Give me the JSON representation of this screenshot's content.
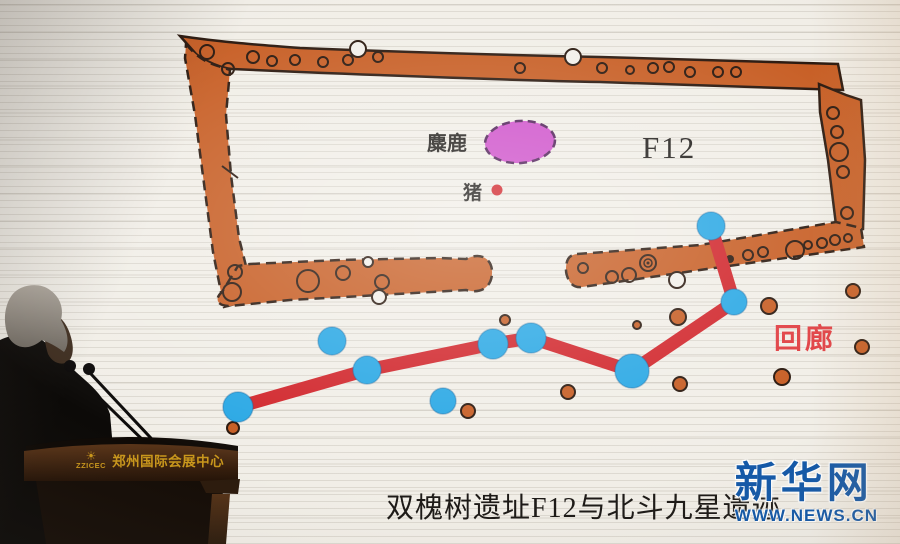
{
  "photo": {
    "caption": "双槐树遗址F12与北斗九星遗迹"
  },
  "slide": {
    "labels": {
      "elk": "麋鹿",
      "pig": "猪",
      "building": "F12",
      "corridor": "回廊"
    }
  },
  "watermark": {
    "site_name": "新华网",
    "site_url": "WWW.NEWS.CN"
  },
  "podium": {
    "abbr": "ZZICEC",
    "venue_name": "郑州国际会展中心",
    "sunburst_icon": "☀"
  },
  "colors": {
    "wall": "#c65a1f",
    "wall_outline": "#241208",
    "star": "#25a6e4",
    "line": "#d02127",
    "oval": "#ce4fca",
    "oval_outline": "#4d1c55",
    "corridor_label": "#e03a3e",
    "logo_blue": "#1459a8",
    "gold": "#c9971c"
  },
  "diagram": {
    "elk_oval": {
      "x": 520,
      "y": 142,
      "rx": 35,
      "ry": 21
    },
    "pig_dot": {
      "x": 497,
      "y": 190,
      "r": 5.5
    },
    "stars_linked": [
      {
        "x": 238,
        "y": 407,
        "r": 15
      },
      {
        "x": 367,
        "y": 370,
        "r": 14
      },
      {
        "x": 493,
        "y": 344,
        "r": 15
      },
      {
        "x": 531,
        "y": 338,
        "r": 15
      },
      {
        "x": 632,
        "y": 371,
        "r": 17
      },
      {
        "x": 734,
        "y": 302,
        "r": 13
      },
      {
        "x": 711,
        "y": 226,
        "r": 14
      }
    ],
    "stars_free": [
      {
        "x": 332,
        "y": 341,
        "r": 14
      },
      {
        "x": 443,
        "y": 401,
        "r": 13
      }
    ],
    "postholes_outside": [
      {
        "x": 233,
        "y": 428,
        "r": 6
      },
      {
        "x": 468,
        "y": 411,
        "r": 7
      },
      {
        "x": 505,
        "y": 320,
        "r": 5
      },
      {
        "x": 568,
        "y": 392,
        "r": 7
      },
      {
        "x": 637,
        "y": 325,
        "r": 4
      },
      {
        "x": 678,
        "y": 317,
        "r": 8
      },
      {
        "x": 680,
        "y": 384,
        "r": 7
      },
      {
        "x": 782,
        "y": 377,
        "r": 8
      },
      {
        "x": 769,
        "y": 306,
        "r": 8
      },
      {
        "x": 853,
        "y": 291,
        "r": 7
      },
      {
        "x": 862,
        "y": 347,
        "r": 7
      }
    ],
    "wall_holes": [
      {
        "x": 207,
        "y": 52,
        "r": 7
      },
      {
        "x": 228,
        "y": 69,
        "r": 6
      },
      {
        "x": 253,
        "y": 57,
        "r": 6
      },
      {
        "x": 272,
        "y": 61,
        "r": 5
      },
      {
        "x": 295,
        "y": 60,
        "r": 5
      },
      {
        "x": 323,
        "y": 62,
        "r": 5
      },
      {
        "x": 348,
        "y": 60,
        "r": 5
      },
      {
        "x": 378,
        "y": 57,
        "r": 5
      },
      {
        "x": 520,
        "y": 68,
        "r": 5
      },
      {
        "x": 602,
        "y": 68,
        "r": 5
      },
      {
        "x": 630,
        "y": 70,
        "r": 4
      },
      {
        "x": 653,
        "y": 68,
        "r": 5
      },
      {
        "x": 669,
        "y": 67,
        "r": 5
      },
      {
        "x": 690,
        "y": 72,
        "r": 5
      },
      {
        "x": 718,
        "y": 72,
        "r": 5
      },
      {
        "x": 736,
        "y": 72,
        "r": 5
      },
      {
        "x": 833,
        "y": 113,
        "r": 6
      },
      {
        "x": 837,
        "y": 132,
        "r": 6
      },
      {
        "x": 839,
        "y": 152,
        "r": 9
      },
      {
        "x": 843,
        "y": 172,
        "r": 6
      },
      {
        "x": 847,
        "y": 213,
        "r": 6
      },
      {
        "x": 583,
        "y": 268,
        "r": 5
      },
      {
        "x": 612,
        "y": 277,
        "r": 6
      },
      {
        "x": 629,
        "y": 275,
        "r": 7
      },
      {
        "x": 748,
        "y": 255,
        "r": 5
      },
      {
        "x": 763,
        "y": 252,
        "r": 5
      },
      {
        "x": 795,
        "y": 250,
        "r": 9
      },
      {
        "x": 808,
        "y": 245,
        "r": 4
      },
      {
        "x": 822,
        "y": 243,
        "r": 5
      },
      {
        "x": 835,
        "y": 240,
        "r": 5
      },
      {
        "x": 848,
        "y": 238,
        "r": 4
      },
      {
        "x": 235,
        "y": 272,
        "r": 7
      },
      {
        "x": 232,
        "y": 292,
        "r": 9
      },
      {
        "x": 308,
        "y": 281,
        "r": 11
      },
      {
        "x": 343,
        "y": 273,
        "r": 7
      },
      {
        "x": 382,
        "y": 282,
        "r": 7
      }
    ],
    "white_holes": [
      {
        "x": 358,
        "y": 49,
        "r": 8
      },
      {
        "x": 573,
        "y": 57,
        "r": 8
      },
      {
        "x": 368,
        "y": 262,
        "r": 5
      },
      {
        "x": 379,
        "y": 297,
        "r": 7
      },
      {
        "x": 677,
        "y": 280,
        "r": 8
      }
    ],
    "dark_dots": [
      {
        "x": 730,
        "y": 259,
        "r": 4
      }
    ],
    "double_ring": {
      "x": 648,
      "y": 263,
      "r_outer": 8,
      "r_inner": 4
    }
  }
}
